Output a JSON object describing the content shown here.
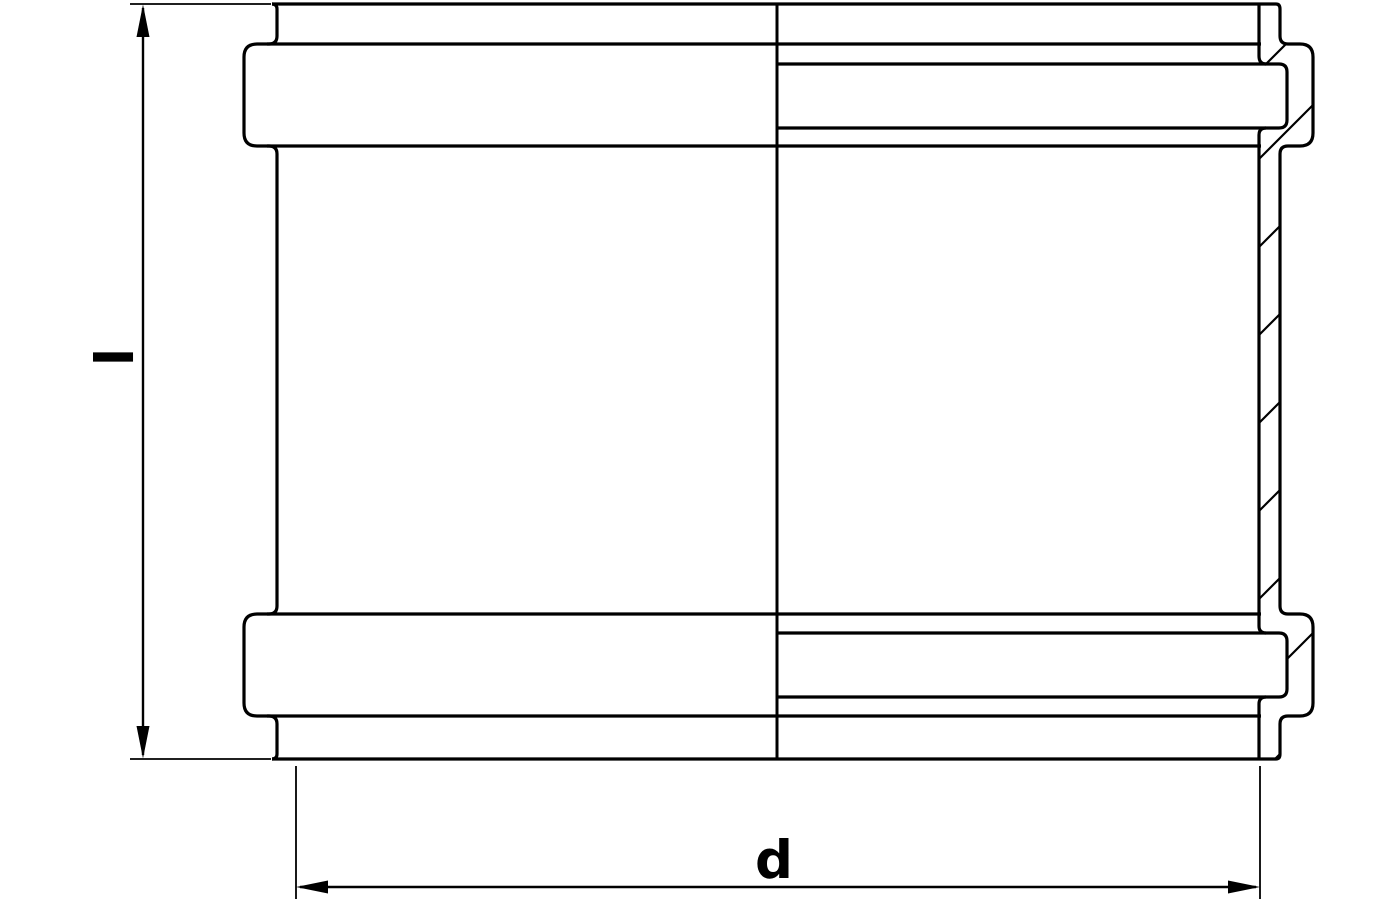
{
  "figure": {
    "kind": "technical drawing - half-section of a pipe coupling sleeve with two sealing ribs and internal grooves",
    "background_color": "#ffffff",
    "line_color": "#000000",
    "dimensions": {
      "length": {
        "label": "l"
      },
      "diameter": {
        "label": "d"
      }
    }
  }
}
